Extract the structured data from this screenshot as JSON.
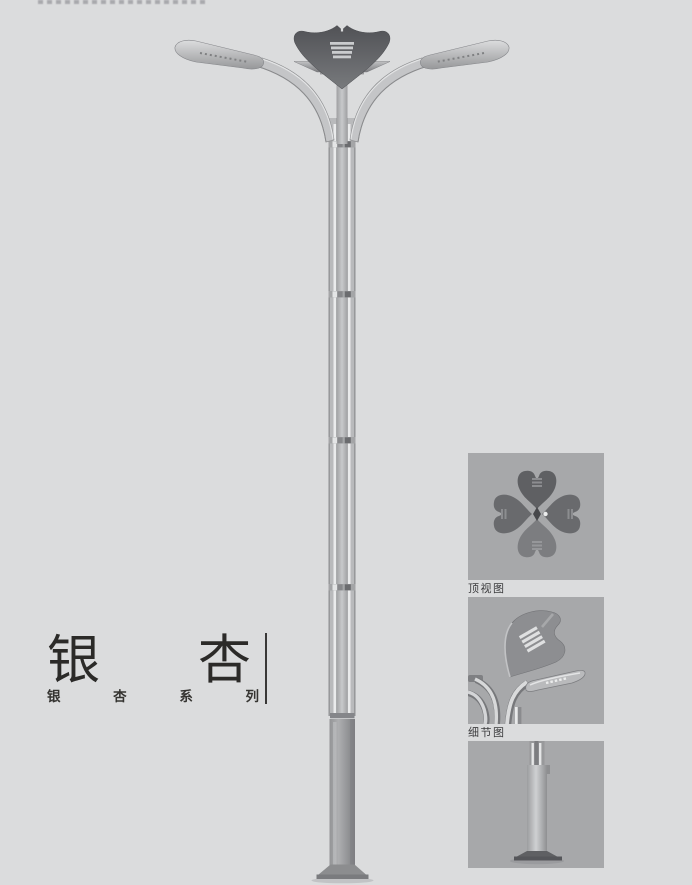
{
  "page": {
    "background": "#dbdcdd"
  },
  "title": {
    "main": [
      "银",
      "杏"
    ],
    "main_text": "银杏",
    "series": [
      "银",
      "杏",
      "系",
      "列"
    ],
    "series_text": "银杏系列"
  },
  "figures": {
    "items": [
      {
        "id": "top-view",
        "label": "顶视图"
      },
      {
        "id": "detail-view",
        "label": "细节图"
      },
      {
        "id": "base-view",
        "label": ""
      }
    ]
  },
  "illustration": {
    "subject": "ginkgo-leaf double-arm street lamp pole",
    "colors": {
      "panel_bg": "#a7a8aa",
      "metal_light": "#c6c7c9",
      "metal_mid": "#9b9c9e",
      "leaf_dark": "#55565a",
      "base_dark": "#87888a",
      "title_color": "#2b2a28"
    }
  }
}
